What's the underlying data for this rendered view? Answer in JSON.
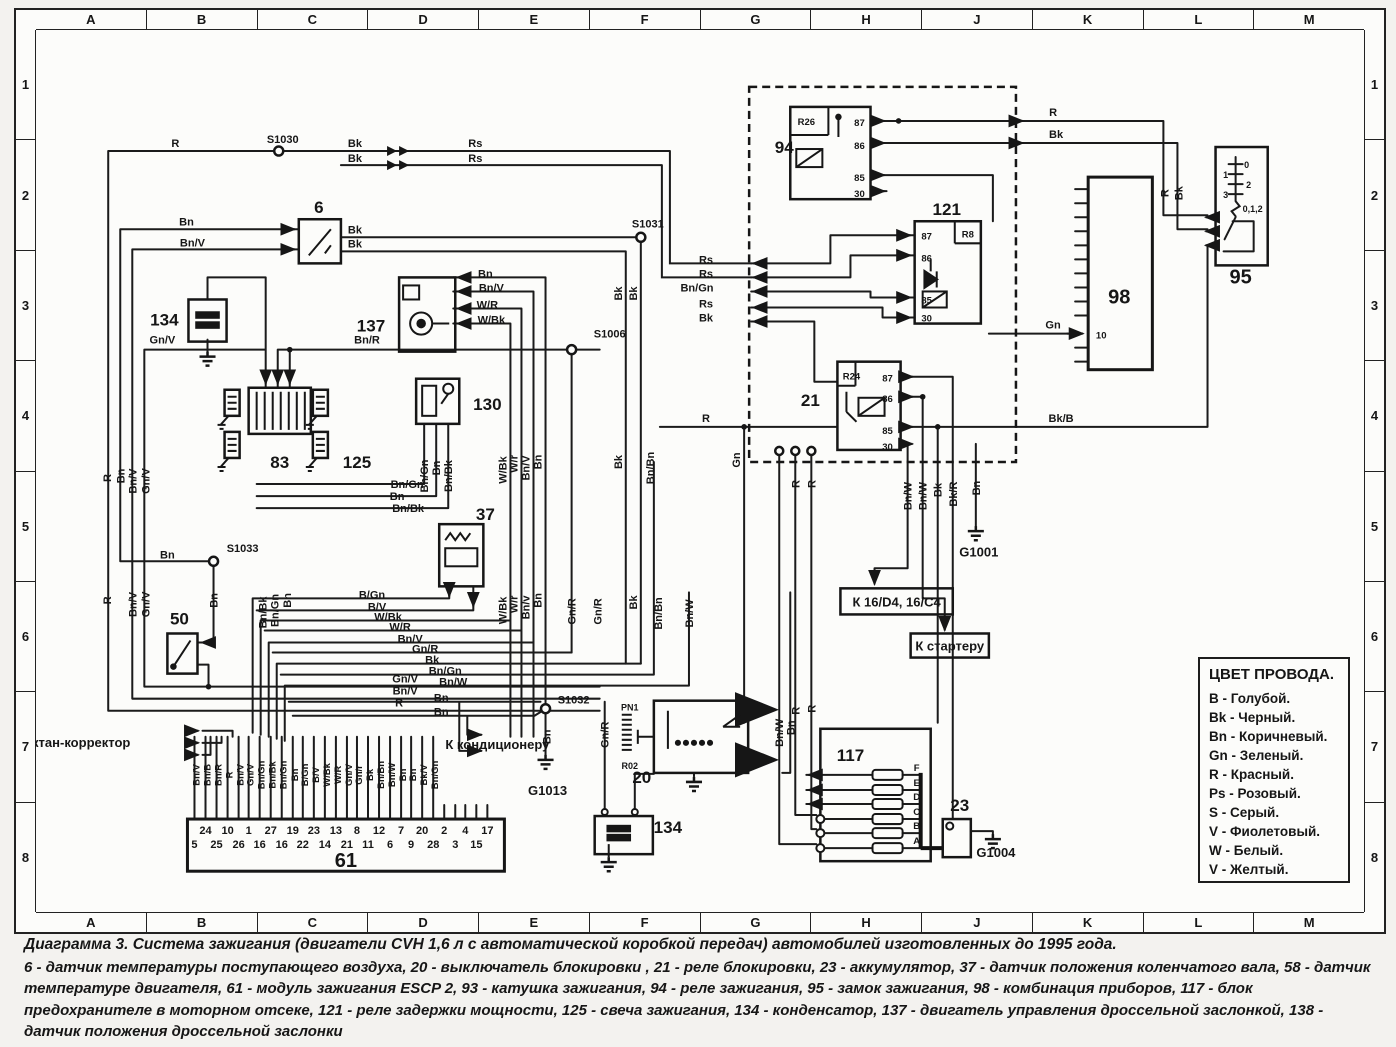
{
  "grid": {
    "cols": [
      "A",
      "B",
      "C",
      "D",
      "E",
      "F",
      "G",
      "H",
      "J",
      "K",
      "L",
      "M"
    ],
    "rows": [
      "1",
      "2",
      "3",
      "4",
      "5",
      "6",
      "7",
      "8"
    ]
  },
  "legend": {
    "title": "ЦВЕТ ПРОВОДА.",
    "entries": [
      [
        "B",
        "Голубой."
      ],
      [
        "Bk",
        "Черный."
      ],
      [
        "Bn",
        "Коричневый."
      ],
      [
        "Gn",
        "Зеленый."
      ],
      [
        "R",
        "Красный."
      ],
      [
        "Ps",
        "Розовый."
      ],
      [
        "S",
        "Серый."
      ],
      [
        "V",
        "Фиолетовый."
      ],
      [
        "W",
        "Белый."
      ],
      [
        "V",
        "Желтый."
      ]
    ]
  },
  "caption": {
    "title": "Диаграмма 3. Система зажигания (двигатели CVH 1,6 л с автоматической коробкой передач) автомобилей изготовленных до 1995 года.",
    "body": "6 - датчик температуры поступающего воздуха, 20 - выключатель блокировки , 21 - реле блокировки, 23 - аккумулятор, 37 - датчик положения коленчатого вала, 58 - датчик температуре двигателя, 61 - модуль зажигания ESCP 2, 93 - катушка зажигания, 94 - реле зажигания, 95 - замок зажигания, 98 - комбинация приборов, 117 - блок предохранителе в моторном отсеке, 121 - реле задержки мощности, 125 - свеча зажигания, 134 - конденсатор, 137 - двигатель управления дроссельной заслонкой, 138 - датчик положения дроссельной заслонки"
  },
  "diagram": {
    "labels": [
      {
        "t": "R",
        "x": 139,
        "y": 116
      },
      {
        "t": "S1030",
        "x": 246,
        "y": 112,
        "n": "splice-s1030-label"
      },
      {
        "t": "Bk",
        "x": 318,
        "y": 116
      },
      {
        "t": "Bk",
        "x": 318,
        "y": 131
      },
      {
        "t": "Rs",
        "x": 438,
        "y": 116
      },
      {
        "t": "Rs",
        "x": 438,
        "y": 131
      },
      {
        "t": "6",
        "x": 282,
        "y": 182,
        "c": "b",
        "n": "component-6-label"
      },
      {
        "t": "Bn",
        "x": 150,
        "y": 194
      },
      {
        "t": "Bn/V",
        "x": 156,
        "y": 215
      },
      {
        "t": "Bk",
        "x": 318,
        "y": 202
      },
      {
        "t": "Bk",
        "x": 318,
        "y": 216
      },
      {
        "t": "S1031",
        "x": 610,
        "y": 196,
        "n": "splice-s1031-label"
      },
      {
        "t": "134",
        "x": 128,
        "y": 294,
        "c": "b",
        "n": "component-134a-label"
      },
      {
        "t": "137",
        "x": 334,
        "y": 300,
        "c": "b",
        "n": "component-137-label"
      },
      {
        "t": "Bn",
        "x": 448,
        "y": 246
      },
      {
        "t": "Bn/V",
        "x": 454,
        "y": 260
      },
      {
        "t": "W/R",
        "x": 450,
        "y": 277
      },
      {
        "t": "W/Bk",
        "x": 454,
        "y": 292
      },
      {
        "t": "S1006",
        "x": 572,
        "y": 306,
        "n": "splice-s1006-label"
      },
      {
        "t": "Gn/V",
        "x": 126,
        "y": 312
      },
      {
        "t": "Bn/R",
        "x": 330,
        "y": 312
      },
      {
        "t": "130",
        "x": 450,
        "y": 378,
        "c": "b",
        "n": "component-130-label"
      },
      {
        "t": "83",
        "x": 243,
        "y": 436,
        "c": "b",
        "n": "component-83-label"
      },
      {
        "t": "125",
        "x": 320,
        "y": 436,
        "c": "b",
        "n": "component-125-label"
      },
      {
        "t": "Bn/Gn",
        "x": 391,
        "y": 444,
        "r": 1
      },
      {
        "t": "Bn",
        "x": 403,
        "y": 436,
        "r": 1
      },
      {
        "t": "Bn/Bk",
        "x": 415,
        "y": 444,
        "r": 1
      },
      {
        "t": "W/Bk",
        "x": 469,
        "y": 438,
        "r": 1
      },
      {
        "t": "W/r",
        "x": 480,
        "y": 432,
        "r": 1
      },
      {
        "t": "Bn/V",
        "x": 492,
        "y": 436,
        "r": 1
      },
      {
        "t": "Bn",
        "x": 504,
        "y": 430,
        "r": 1
      },
      {
        "t": "Bk",
        "x": 584,
        "y": 262,
        "r": 1
      },
      {
        "t": "Bk",
        "x": 599,
        "y": 262,
        "r": 1
      },
      {
        "t": "Bk",
        "x": 584,
        "y": 430,
        "r": 1
      },
      {
        "t": "Bn/Bn",
        "x": 616,
        "y": 436,
        "r": 1
      },
      {
        "t": "37",
        "x": 448,
        "y": 488,
        "c": "b",
        "n": "component-37-label"
      },
      {
        "t": "Bn/Gn",
        "x": 370,
        "y": 456
      },
      {
        "t": "Bn",
        "x": 360,
        "y": 468
      },
      {
        "t": "Bn/Bk",
        "x": 371,
        "y": 480
      },
      {
        "t": "S1033",
        "x": 206,
        "y": 520,
        "n": "splice-s1033-label"
      },
      {
        "t": "Bn",
        "x": 131,
        "y": 526
      },
      {
        "t": "R",
        "x": 75,
        "y": 446,
        "r": 1
      },
      {
        "t": "Bn",
        "x": 88,
        "y": 444,
        "r": 1
      },
      {
        "t": "Bn/V",
        "x": 100,
        "y": 449,
        "r": 1
      },
      {
        "t": "Gn/V",
        "x": 113,
        "y": 449,
        "r": 1
      },
      {
        "t": "50",
        "x": 143,
        "y": 592,
        "c": "b",
        "n": "component-50-label"
      },
      {
        "t": "R",
        "x": 75,
        "y": 568,
        "r": 1
      },
      {
        "t": "Bn/V",
        "x": 100,
        "y": 572,
        "r": 1
      },
      {
        "t": "Gn/V",
        "x": 113,
        "y": 572,
        "r": 1
      },
      {
        "t": "Bn",
        "x": 181,
        "y": 568,
        "r": 1
      },
      {
        "t": "Bn/Bk",
        "x": 230,
        "y": 580,
        "r": 1
      },
      {
        "t": "Bn/Gn",
        "x": 242,
        "y": 578,
        "r": 1
      },
      {
        "t": "Bn",
        "x": 254,
        "y": 568,
        "r": 1
      },
      {
        "t": "Gn/V",
        "x": 368,
        "y": 650
      },
      {
        "t": "Bn/V",
        "x": 368,
        "y": 662
      },
      {
        "t": "R",
        "x": 362,
        "y": 674
      },
      {
        "t": "Октан-корректор",
        "x": 40,
        "y": 714,
        "c": "m",
        "a": "start",
        "n": "octane-corrector-label"
      },
      {
        "t": "B/Gn",
        "x": 335,
        "y": 566
      },
      {
        "t": "B/V",
        "x": 340,
        "y": 578
      },
      {
        "t": "W/Bk",
        "x": 351,
        "y": 588
      },
      {
        "t": "W/R",
        "x": 363,
        "y": 598
      },
      {
        "t": "Bn/V",
        "x": 373,
        "y": 610
      },
      {
        "t": "Gn/R",
        "x": 388,
        "y": 620
      },
      {
        "t": "Bk",
        "x": 395,
        "y": 631
      },
      {
        "t": "Bn/Gn",
        "x": 408,
        "y": 642
      },
      {
        "t": "Bn/W",
        "x": 416,
        "y": 653
      },
      {
        "t": "Bn",
        "x": 404,
        "y": 669
      },
      {
        "t": "Bn",
        "x": 404,
        "y": 683
      },
      {
        "t": "К кондиционеру",
        "x": 460,
        "y": 716,
        "c": "mb",
        "a": "start",
        "n": "to-air-conditioner-label"
      },
      {
        "t": "S1032",
        "x": 536,
        "y": 671,
        "n": "splice-s1032-label"
      },
      {
        "t": "Bn",
        "x": 513,
        "y": 704,
        "r": 1
      },
      {
        "t": "G1013",
        "x": 510,
        "y": 762,
        "c": "m",
        "n": "ground-g1013-label"
      },
      {
        "t": "Gn/R",
        "x": 571,
        "y": 702,
        "r": 1
      },
      {
        "t": "W/Bk",
        "x": 469,
        "y": 578,
        "r": 1
      },
      {
        "t": "W/r",
        "x": 480,
        "y": 572,
        "r": 1
      },
      {
        "t": "Bn/v",
        "x": 492,
        "y": 575,
        "r": 1
      },
      {
        "t": "Bn",
        "x": 504,
        "y": 568,
        "r": 1
      },
      {
        "t": "Gn/R",
        "x": 538,
        "y": 579,
        "r": 1
      },
      {
        "t": "Gn/R",
        "x": 564,
        "y": 579,
        "r": 1
      },
      {
        "t": "Bk",
        "x": 599,
        "y": 570,
        "r": 1
      },
      {
        "t": "Bn/Bn",
        "x": 624,
        "y": 581,
        "r": 1
      },
      {
        "t": "Bn/W",
        "x": 655,
        "y": 581,
        "r": 1
      },
      {
        "t": "Gn",
        "x": 702,
        "y": 428,
        "r": 1
      },
      {
        "t": "20",
        "x": 604,
        "y": 750,
        "c": "b",
        "n": "component-20-label"
      },
      {
        "t": "PN1",
        "x": 592,
        "y": 678,
        "c": "t"
      },
      {
        "t": "R02",
        "x": 592,
        "y": 736,
        "c": "t"
      },
      {
        "t": "134",
        "x": 630,
        "y": 800,
        "c": "b",
        "a": "start",
        "n": "component-134b-label"
      },
      {
        "t": "61",
        "x": 309,
        "y": 834,
        "c": "h",
        "n": "component-61-label"
      },
      {
        "t": "24",
        "x": 169,
        "y": 801
      },
      {
        "t": "10",
        "x": 191,
        "y": 801
      },
      {
        "t": "1",
        "x": 212,
        "y": 801
      },
      {
        "t": "27",
        "x": 234,
        "y": 801
      },
      {
        "t": "19",
        "x": 256,
        "y": 801
      },
      {
        "t": "23",
        "x": 277,
        "y": 801
      },
      {
        "t": "13",
        "x": 299,
        "y": 801
      },
      {
        "t": "8",
        "x": 320,
        "y": 801
      },
      {
        "t": "12",
        "x": 342,
        "y": 801
      },
      {
        "t": "7",
        "x": 364,
        "y": 801
      },
      {
        "t": "20",
        "x": 385,
        "y": 801
      },
      {
        "t": "2",
        "x": 407,
        "y": 801
      },
      {
        "t": "4",
        "x": 428,
        "y": 801
      },
      {
        "t": "17",
        "x": 450,
        "y": 801
      },
      {
        "t": "5",
        "x": 158,
        "y": 815
      },
      {
        "t": "25",
        "x": 180,
        "y": 815
      },
      {
        "t": "26",
        "x": 202,
        "y": 815
      },
      {
        "t": "16",
        "x": 223,
        "y": 815
      },
      {
        "t": "16",
        "x": 245,
        "y": 815
      },
      {
        "t": "22",
        "x": 266,
        "y": 815
      },
      {
        "t": "14",
        "x": 288,
        "y": 815
      },
      {
        "t": "21",
        "x": 310,
        "y": 815
      },
      {
        "t": "11",
        "x": 331,
        "y": 815
      },
      {
        "t": "6",
        "x": 353,
        "y": 815
      },
      {
        "t": "9",
        "x": 374,
        "y": 815
      },
      {
        "t": "28",
        "x": 396,
        "y": 815
      },
      {
        "t": "3",
        "x": 418,
        "y": 815
      },
      {
        "t": "15",
        "x": 439,
        "y": 815
      },
      {
        "t": "Bn/V",
        "x": 163,
        "y": 742,
        "r": 1,
        "c": "s"
      },
      {
        "t": "Bn/B",
        "x": 174,
        "y": 742,
        "r": 1,
        "c": "s"
      },
      {
        "t": "Bn/R",
        "x": 185,
        "y": 742,
        "r": 1,
        "c": "s"
      },
      {
        "t": "R",
        "x": 196,
        "y": 742,
        "r": 1,
        "c": "s"
      },
      {
        "t": "Bn/V",
        "x": 207,
        "y": 742,
        "r": 1,
        "c": "s"
      },
      {
        "t": "Gn/V",
        "x": 217,
        "y": 742,
        "r": 1,
        "c": "s"
      },
      {
        "t": "Bn/Gn",
        "x": 228,
        "y": 742,
        "r": 1,
        "c": "s"
      },
      {
        "t": "Bn/Bk",
        "x": 239,
        "y": 742,
        "r": 1,
        "c": "s"
      },
      {
        "t": "Bn/Gn",
        "x": 250,
        "y": 742,
        "r": 1,
        "c": "s"
      },
      {
        "t": "Bn",
        "x": 261,
        "y": 742,
        "r": 1,
        "c": "s"
      },
      {
        "t": "B/Gn",
        "x": 271,
        "y": 742,
        "r": 1,
        "c": "s"
      },
      {
        "t": "B/V",
        "x": 282,
        "y": 742,
        "r": 1,
        "c": "s"
      },
      {
        "t": "W/Bk",
        "x": 293,
        "y": 742,
        "r": 1,
        "c": "s"
      },
      {
        "t": "W/R",
        "x": 304,
        "y": 742,
        "r": 1,
        "c": "s"
      },
      {
        "t": "Gn/V",
        "x": 315,
        "y": 742,
        "r": 1,
        "c": "s"
      },
      {
        "t": "Gn/r",
        "x": 325,
        "y": 742,
        "r": 1,
        "c": "s"
      },
      {
        "t": "Bk",
        "x": 336,
        "y": 742,
        "r": 1,
        "c": "s"
      },
      {
        "t": "Bn/Bn",
        "x": 347,
        "y": 742,
        "r": 1,
        "c": "s"
      },
      {
        "t": "Bn/W",
        "x": 358,
        "y": 742,
        "r": 1,
        "c": "s"
      },
      {
        "t": "Bn",
        "x": 369,
        "y": 742,
        "r": 1,
        "c": "s"
      },
      {
        "t": "Bn",
        "x": 379,
        "y": 742,
        "r": 1,
        "c": "s"
      },
      {
        "t": "Bk/V",
        "x": 390,
        "y": 742,
        "r": 1,
        "c": "s"
      },
      {
        "t": "Bn/Gn",
        "x": 401,
        "y": 742,
        "r": 1,
        "c": "s"
      },
      {
        "t": "94",
        "x": 746,
        "y": 122,
        "c": "b",
        "n": "relay-94-label"
      },
      {
        "t": "R26",
        "x": 768,
        "y": 94,
        "c": "s"
      },
      {
        "t": "87",
        "x": 821,
        "y": 95,
        "c": "s"
      },
      {
        "t": "86",
        "x": 821,
        "y": 118,
        "c": "s"
      },
      {
        "t": "85",
        "x": 821,
        "y": 150,
        "c": "s"
      },
      {
        "t": "30",
        "x": 821,
        "y": 166,
        "c": "s"
      },
      {
        "t": "121",
        "x": 908,
        "y": 184,
        "c": "b",
        "n": "relay-121-label"
      },
      {
        "t": "R8",
        "x": 929,
        "y": 206,
        "c": "s"
      },
      {
        "t": "87",
        "x": 888,
        "y": 208,
        "c": "s"
      },
      {
        "t": "86",
        "x": 888,
        "y": 230,
        "c": "s"
      },
      {
        "t": "85",
        "x": 888,
        "y": 272,
        "c": "s"
      },
      {
        "t": "30",
        "x": 888,
        "y": 290,
        "c": "s"
      },
      {
        "t": "21",
        "x": 772,
        "y": 374,
        "c": "b",
        "n": "relay-21-label"
      },
      {
        "t": "R24",
        "x": 813,
        "y": 348,
        "c": "s"
      },
      {
        "t": "87",
        "x": 849,
        "y": 350,
        "c": "s"
      },
      {
        "t": "86",
        "x": 849,
        "y": 370,
        "c": "s"
      },
      {
        "t": "85",
        "x": 849,
        "y": 402,
        "c": "s"
      },
      {
        "t": "30",
        "x": 849,
        "y": 418,
        "c": "s"
      },
      {
        "t": "Rs",
        "x": 668,
        "y": 232
      },
      {
        "t": "Rs",
        "x": 668,
        "y": 246
      },
      {
        "t": "Bn/Gn",
        "x": 659,
        "y": 260
      },
      {
        "t": "Rs",
        "x": 668,
        "y": 276
      },
      {
        "t": "Bk",
        "x": 668,
        "y": 290
      },
      {
        "t": "R",
        "x": 1014,
        "y": 85
      },
      {
        "t": "Bk",
        "x": 1017,
        "y": 107
      },
      {
        "t": "R",
        "x": 1129,
        "y": 162,
        "r": 1
      },
      {
        "t": "Bk",
        "x": 1143,
        "y": 162,
        "r": 1
      },
      {
        "t": "98",
        "x": 1080,
        "y": 272,
        "c": "h",
        "n": "component-98-label"
      },
      {
        "t": "10",
        "x": 1062,
        "y": 307,
        "c": "s",
        "a": "start"
      },
      {
        "t": "Gn",
        "x": 1014,
        "y": 297
      },
      {
        "t": "95",
        "x": 1201,
        "y": 252,
        "c": "h",
        "n": "component-95-label"
      },
      {
        "t": "0",
        "x": 1207,
        "y": 137,
        "c": "t"
      },
      {
        "t": "1",
        "x": 1186,
        "y": 147,
        "c": "t"
      },
      {
        "t": "2",
        "x": 1209,
        "y": 157,
        "c": "t"
      },
      {
        "t": "3",
        "x": 1186,
        "y": 167,
        "c": "t"
      },
      {
        "t": "0,1,2",
        "x": 1213,
        "y": 181,
        "c": "t"
      },
      {
        "t": "Bk/B",
        "x": 1022,
        "y": 390
      },
      {
        "t": "R",
        "x": 668,
        "y": 390
      },
      {
        "t": "R",
        "x": 761,
        "y": 452,
        "r": 1
      },
      {
        "t": "R",
        "x": 777,
        "y": 452,
        "r": 1
      },
      {
        "t": "Bn/W",
        "x": 873,
        "y": 464,
        "r": 1
      },
      {
        "t": "Bn/W",
        "x": 888,
        "y": 464,
        "r": 1
      },
      {
        "t": "Bk",
        "x": 903,
        "y": 458,
        "r": 1
      },
      {
        "t": "Bk/R",
        "x": 918,
        "y": 462,
        "r": 1
      },
      {
        "t": "Bn",
        "x": 941,
        "y": 456,
        "r": 1
      },
      {
        "t": "G1001",
        "x": 940,
        "y": 524,
        "c": "m",
        "n": "ground-g1001-label"
      },
      {
        "t": "К 16/D4, 16/C4",
        "x": 858,
        "y": 574,
        "c": "mb",
        "n": "to-16d4-box-label"
      },
      {
        "t": "К стартеру",
        "x": 911,
        "y": 618,
        "c": "mb",
        "n": "to-starter-box-label"
      },
      {
        "t": "Bn/W",
        "x": 745,
        "y": 700,
        "r": 1
      },
      {
        "t": "Bn",
        "x": 756,
        "y": 695,
        "r": 1
      },
      {
        "t": "R",
        "x": 761,
        "y": 678,
        "r": 1
      },
      {
        "t": "R",
        "x": 777,
        "y": 676,
        "r": 1
      },
      {
        "t": "117",
        "x": 812,
        "y": 728,
        "c": "b",
        "n": "component-117-label"
      },
      {
        "t": "F",
        "x": 878,
        "y": 738,
        "c": "s"
      },
      {
        "t": "E",
        "x": 878,
        "y": 753,
        "c": "s"
      },
      {
        "t": "D",
        "x": 878,
        "y": 767,
        "c": "s"
      },
      {
        "t": "C",
        "x": 878,
        "y": 782,
        "c": "s"
      },
      {
        "t": "B",
        "x": 878,
        "y": 796,
        "c": "s"
      },
      {
        "t": "A",
        "x": 878,
        "y": 811,
        "c": "s"
      },
      {
        "t": "23",
        "x": 921,
        "y": 778,
        "c": "b",
        "n": "component-23-label"
      },
      {
        "t": "G1004",
        "x": 957,
        "y": 824,
        "c": "m",
        "n": "ground-g1004-label"
      }
    ]
  }
}
